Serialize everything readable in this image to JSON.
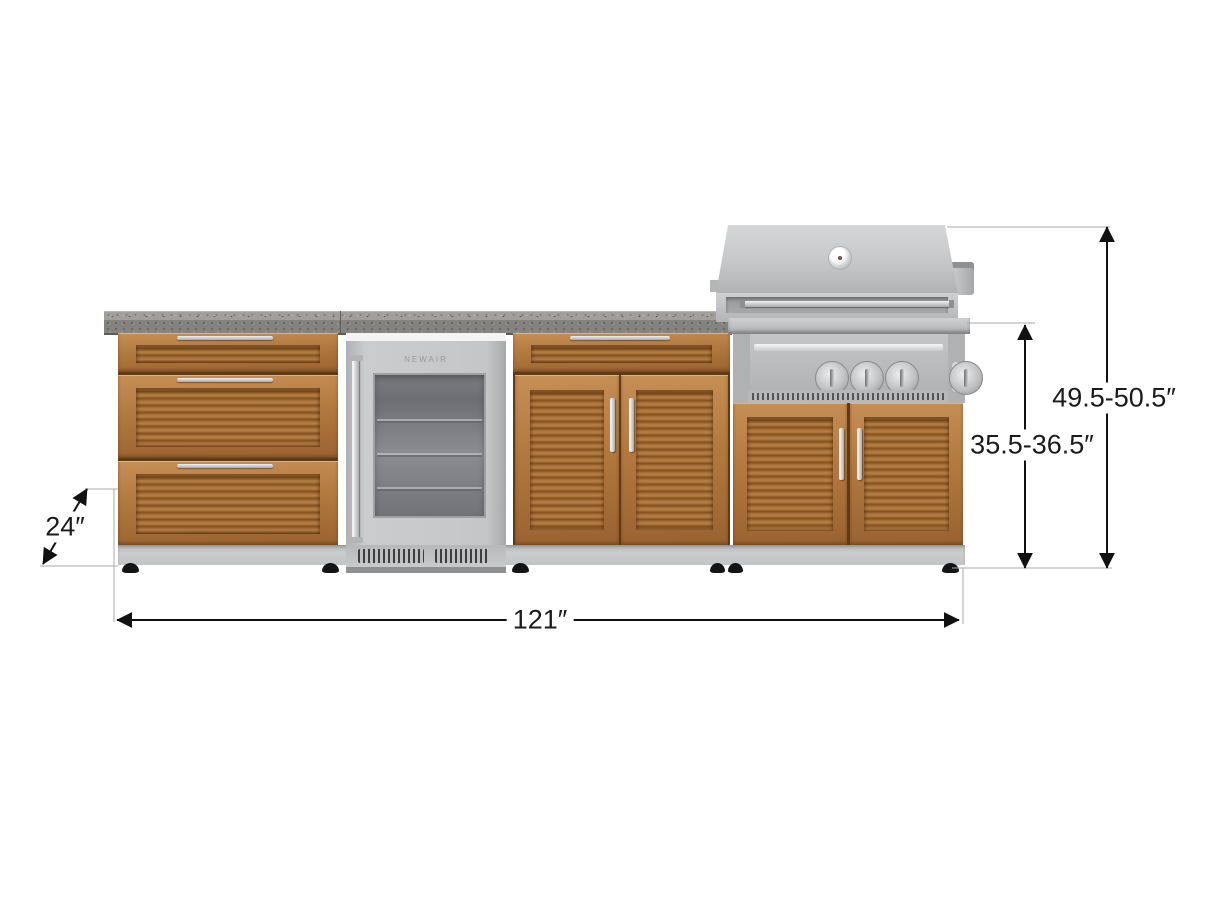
{
  "figure": {
    "type": "product-dimension-diagram",
    "subject": "Outdoor kitchen cabinet set with 3-drawer cabinet, beverage fridge, bar cabinet and built-in gas grill"
  },
  "annotations": {
    "depth": {
      "label": "24″"
    },
    "width": {
      "label": "121″"
    },
    "counter_height": {
      "label": "35.5-36.5″"
    },
    "overall_height": {
      "label": "49.5-50.5″"
    }
  },
  "fridge": {
    "brand": "NEWAIR"
  },
  "components": [
    "three-drawer-cabinet",
    "beverage-fridge",
    "bar-cabinet",
    "grill-cabinet",
    "gas-grill",
    "countertop"
  ],
  "colors": {
    "wood_frame": "#b2793f",
    "wood_slat_dark": "#82501f",
    "countertop": "#85837f",
    "stainless": "#c6c7c9",
    "plinth": "#c3c4c6",
    "dimension_line": "#111111",
    "reference_line": "#a8a8a8",
    "background": "#ffffff"
  }
}
